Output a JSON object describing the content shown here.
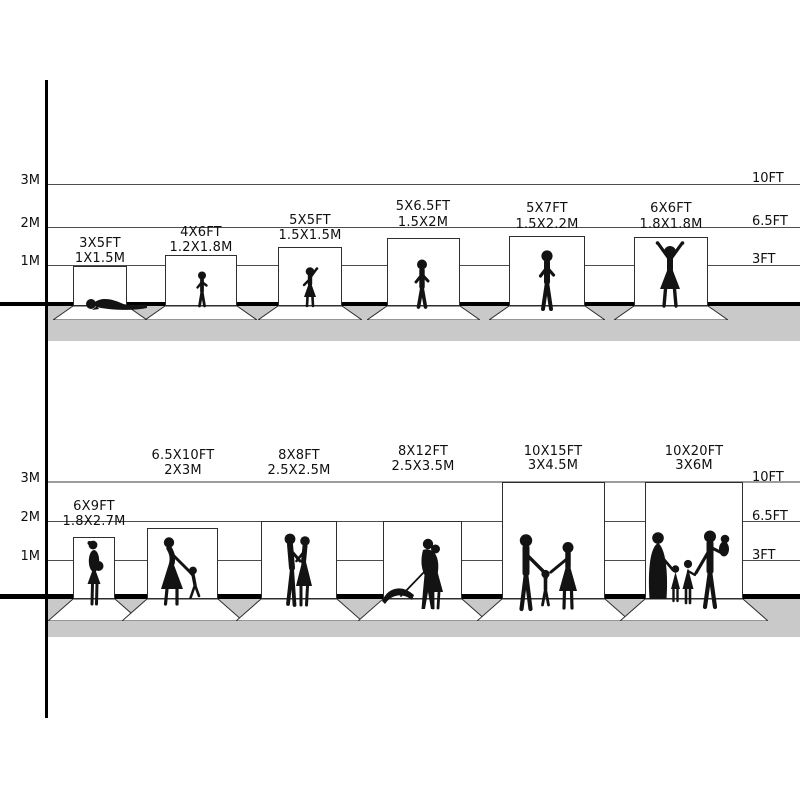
{
  "title": "Photography backdrop size comparison chart",
  "colors": {
    "background": "#ffffff",
    "line": "#000000",
    "gridline": "#4d4d4d",
    "soft_gridline": "#9c9c9c",
    "shadow_band": "#c9c9ca",
    "backdrop_fill": "#ffffff",
    "backdrop_border": "#2e2e2e",
    "silhouette": "#131313"
  },
  "sections": [
    {
      "id": "small-backdrops",
      "left_scale": [
        "3M",
        "2M",
        "1M"
      ],
      "right_scale": [
        "10FT",
        "6.5FT",
        "3FT"
      ],
      "backdrops": [
        {
          "ft": "3X5FT",
          "m": "1X1.5M",
          "figure": "crawling-baby"
        },
        {
          "ft": "4X6FT",
          "m": "1.2X1.8M",
          "figure": "standing-toddler"
        },
        {
          "ft": "5X5FT",
          "m": "1.5X1.5M",
          "figure": "waving-girl"
        },
        {
          "ft": "5X6.5FT",
          "m": "1.5X2M",
          "figure": "standing-boy"
        },
        {
          "ft": "5X7FT",
          "m": "1.5X2.2M",
          "figure": "standing-child"
        },
        {
          "ft": "6X6FT",
          "m": "1.8X1.8M",
          "figure": "cheering-girl"
        }
      ]
    },
    {
      "id": "large-backdrops",
      "left_scale": [
        "3M",
        "2M",
        "1M"
      ],
      "right_scale": [
        "10FT",
        "6.5FT",
        "3FT"
      ],
      "backdrops": [
        {
          "ft": "6X9FT",
          "m": "1.8X2.7M",
          "figure": "pregnant-woman"
        },
        {
          "ft": "6.5X10FT",
          "m": "2X3M",
          "figure": "mother-and-child"
        },
        {
          "ft": "8X8FT",
          "m": "2.5X2.5M",
          "figure": "kissing-couple"
        },
        {
          "ft": "8X12FT",
          "m": "2.5X3.5M",
          "figure": "couple-with-umbrella"
        },
        {
          "ft": "10X15FT",
          "m": "3X4.5M",
          "figure": "family-of-three"
        },
        {
          "ft": "10X20FT",
          "m": "3X6M",
          "figure": "family-of-five"
        }
      ]
    }
  ]
}
